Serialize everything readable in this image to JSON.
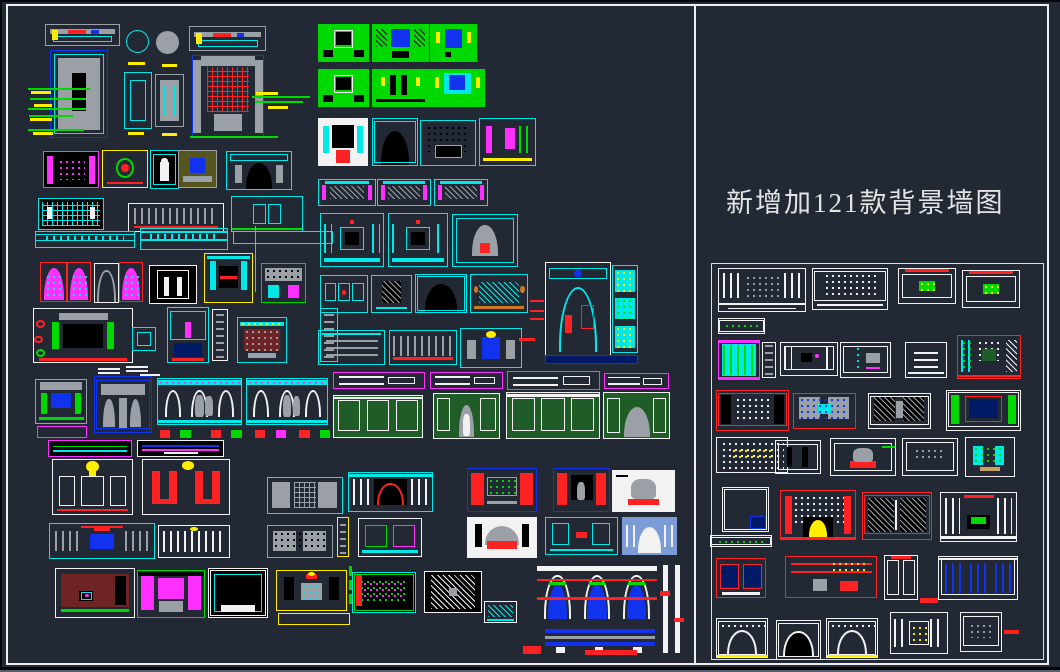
{
  "app": {
    "background_color": "#222935",
    "frame_color": "#eeeeee",
    "description": "CAD drawing sheet of background wall design elevations"
  },
  "title": {
    "text": "新增加121款背景墙图",
    "color": "#e3e3e3"
  },
  "palette": {
    "cy": "#00e8e8",
    "gr": "#00d900",
    "rd": "#ff2222",
    "mg": "#ff30ff",
    "yl": "#ffee00",
    "wh": "#f2f2f2",
    "gy": "#9aa0a6",
    "bl": "#1133ee",
    "nv": "#001a66",
    "dg": "#1f5c28",
    "mr": "#6e2424",
    "pw": "#7b9cd6",
    "bk": "#000000",
    "or": "#cc7a22",
    "tn": "#c8a165",
    "ol": "#55551e"
  },
  "drawings": {
    "blocks": [
      [
        45,
        24,
        75,
        22,
        "gy",
        "",
        "plan"
      ],
      [
        50,
        50,
        58,
        88,
        "bl",
        "",
        "tvblue"
      ],
      [
        126,
        30,
        23,
        23,
        "cy",
        "",
        "circle"
      ],
      [
        156,
        31,
        23,
        23,
        "gy",
        "gy",
        "circle"
      ],
      [
        124,
        72,
        28,
        57,
        "cy",
        "",
        "frame"
      ],
      [
        155,
        74,
        29,
        53,
        "gy",
        "",
        "slab"
      ],
      [
        189,
        26,
        77,
        25,
        "gy",
        "",
        "plan"
      ],
      [
        192,
        55,
        72,
        83,
        "bl",
        "",
        "redgrid"
      ],
      [
        43,
        151,
        56,
        37,
        "mg",
        "bk",
        "cols"
      ],
      [
        102,
        150,
        46,
        38,
        "yl",
        "",
        "art"
      ],
      [
        150,
        150,
        29,
        39,
        "cy",
        "bk",
        "jar"
      ],
      [
        178,
        150,
        39,
        38,
        "gy",
        "ol",
        "olive"
      ],
      [
        226,
        151,
        66,
        39,
        "cy",
        "",
        "fireplace"
      ],
      [
        38,
        198,
        66,
        32,
        "cy",
        "bk",
        "lattice"
      ],
      [
        128,
        203,
        96,
        29,
        "wh",
        "",
        "colonnade"
      ],
      [
        231,
        196,
        72,
        36,
        "cy",
        "",
        "window"
      ],
      [
        318,
        24,
        51,
        38,
        "gr",
        "gr",
        "greenwall"
      ],
      [
        372,
        24,
        57,
        38,
        "gr",
        "gr",
        "greenwall2"
      ],
      [
        430,
        24,
        47,
        38,
        "gr",
        "gr",
        "greenwall3"
      ],
      [
        318,
        69,
        51,
        38,
        "gr",
        "gr",
        "greenwall"
      ],
      [
        372,
        69,
        57,
        38,
        "gr",
        "gr",
        "greenwall4"
      ],
      [
        429,
        69,
        56,
        38,
        "gr",
        "gr",
        "greenwall5"
      ],
      [
        318,
        118,
        50,
        48,
        "wh",
        "wh",
        "whiteart"
      ],
      [
        372,
        118,
        46,
        48,
        "cy",
        "",
        "arch"
      ],
      [
        420,
        120,
        56,
        46,
        "cy",
        "",
        "dots"
      ],
      [
        479,
        118,
        57,
        48,
        "cy",
        "",
        "magdetail"
      ],
      [
        318,
        179,
        58,
        27,
        "cy",
        "",
        "sofa"
      ],
      [
        377,
        179,
        54,
        27,
        "cy",
        "",
        "sofa"
      ],
      [
        434,
        179,
        54,
        27,
        "cy",
        "",
        "sofa"
      ],
      [
        320,
        213,
        64,
        54,
        "cy",
        "",
        "ornate"
      ],
      [
        388,
        213,
        60,
        54,
        "cy",
        "",
        "ornate"
      ],
      [
        452,
        214,
        66,
        53,
        "cy",
        "",
        "archfire"
      ],
      [
        320,
        275,
        48,
        38,
        "cy",
        "",
        "panel3"
      ],
      [
        371,
        275,
        41,
        38,
        "cy",
        "",
        "mirror"
      ],
      [
        415,
        274,
        52,
        39,
        "cy",
        "",
        "arch"
      ],
      [
        470,
        274,
        58,
        39,
        "cy",
        "",
        "xlattice"
      ],
      [
        318,
        330,
        67,
        35,
        "cy",
        "",
        "bands"
      ],
      [
        389,
        330,
        68,
        35,
        "cy",
        "",
        "colonnade"
      ],
      [
        460,
        328,
        62,
        40,
        "cy",
        "",
        "throne"
      ],
      [
        545,
        262,
        66,
        96,
        "wh",
        "",
        "archbig"
      ],
      [
        612,
        265,
        26,
        88,
        "cy",
        "",
        "smallpanels"
      ],
      [
        545,
        355,
        93,
        9,
        "bl",
        "nv",
        "strip"
      ],
      [
        35,
        231,
        100,
        17,
        "cy",
        "",
        "beam"
      ],
      [
        140,
        228,
        88,
        22,
        "cy",
        "",
        "beam"
      ],
      [
        233,
        231,
        100,
        13,
        "cy",
        "",
        "strip"
      ],
      [
        40,
        262,
        27,
        40,
        "rd",
        "",
        "archstain"
      ],
      [
        67,
        262,
        24,
        40,
        "rd",
        "",
        "archstain"
      ],
      [
        94,
        263,
        25,
        40,
        "wh",
        "",
        "archgray"
      ],
      [
        119,
        262,
        24,
        40,
        "rd",
        "",
        "archstain"
      ],
      [
        149,
        265,
        48,
        39,
        "wh",
        "bk",
        "doorframe"
      ],
      [
        204,
        253,
        49,
        50,
        "yl",
        "",
        "yellowbox"
      ],
      [
        261,
        263,
        45,
        40,
        "gr",
        "",
        "hutch"
      ],
      [
        33,
        308,
        100,
        55,
        "wh",
        "",
        "leaderhouse"
      ],
      [
        132,
        327,
        24,
        24,
        "cy",
        "",
        "smallbox"
      ],
      [
        167,
        307,
        42,
        56,
        "cy",
        "",
        "tvnavy"
      ],
      [
        212,
        309,
        16,
        52,
        "wh",
        "",
        "column"
      ],
      [
        237,
        317,
        50,
        46,
        "cy",
        "",
        "maroonsofa"
      ],
      [
        320,
        308,
        18,
        54,
        "cy",
        "",
        "column"
      ],
      [
        35,
        379,
        52,
        45,
        "gy",
        "",
        "graygreen"
      ],
      [
        37,
        426,
        50,
        12,
        "mg",
        "",
        "strip"
      ],
      [
        94,
        376,
        58,
        57,
        "bl",
        "",
        "pavilion"
      ],
      [
        157,
        378,
        85,
        47,
        "cy",
        "",
        "peoplecol"
      ],
      [
        246,
        378,
        82,
        47,
        "cy",
        "",
        "peoplecol"
      ],
      [
        160,
        428,
        170,
        12,
        "",
        "",
        "pedestals"
      ],
      [
        48,
        440,
        84,
        17,
        "mg",
        "bk",
        "sectionstrip"
      ],
      [
        137,
        440,
        87,
        17,
        "wh",
        "bk",
        "sectionstrip2"
      ],
      [
        52,
        459,
        81,
        56,
        "wh",
        "",
        "chandelier"
      ],
      [
        142,
        459,
        88,
        56,
        "wh",
        "",
        "redU"
      ],
      [
        267,
        477,
        76,
        37,
        "cy",
        "",
        "grayhatch"
      ],
      [
        49,
        523,
        106,
        36,
        "cy",
        "",
        "crownwall"
      ],
      [
        158,
        525,
        72,
        33,
        "wh",
        "",
        "whitecols"
      ],
      [
        267,
        525,
        66,
        33,
        "gy",
        "",
        "graypanels"
      ],
      [
        55,
        568,
        80,
        50,
        "wh",
        "",
        "maroontv"
      ],
      [
        137,
        570,
        68,
        48,
        "gr",
        "",
        "magentawall"
      ],
      [
        208,
        568,
        60,
        50,
        "wh",
        "bk",
        "blackfire"
      ],
      [
        276,
        570,
        71,
        41,
        "yl",
        "",
        "yellowwall"
      ],
      [
        278,
        613,
        72,
        12,
        "yl",
        "",
        "strip"
      ],
      [
        352,
        572,
        64,
        41,
        "cy",
        "bk",
        "speckle"
      ],
      [
        424,
        571,
        58,
        42,
        "wh",
        "bk",
        "diaghatch"
      ],
      [
        484,
        601,
        33,
        22,
        "wh",
        "",
        "hatchdetail"
      ],
      [
        537,
        563,
        120,
        62,
        "",
        "",
        "archtrio"
      ],
      [
        545,
        628,
        110,
        25,
        "",
        "",
        "barstack"
      ],
      [
        660,
        565,
        25,
        88,
        "",
        "",
        "vbars"
      ],
      [
        333,
        372,
        92,
        17,
        "mg",
        "",
        "cornice"
      ],
      [
        430,
        372,
        73,
        17,
        "mg",
        "",
        "cornice"
      ],
      [
        507,
        371,
        93,
        19,
        "mg",
        "",
        "cornice"
      ],
      [
        604,
        373,
        65,
        16,
        "mg",
        "",
        "cornice"
      ],
      [
        333,
        395,
        90,
        43,
        "wh",
        "dg",
        "greenpanel"
      ],
      [
        433,
        393,
        67,
        46,
        "wh",
        "dg",
        "greenpanelperson"
      ],
      [
        506,
        392,
        94,
        47,
        "wh",
        "dg",
        "greenpanel"
      ],
      [
        603,
        392,
        67,
        47,
        "wh",
        "dg",
        "greenpanelarch"
      ],
      [
        348,
        472,
        85,
        40,
        "cy",
        "",
        "redarchwall"
      ],
      [
        467,
        468,
        70,
        44,
        "bl",
        "",
        "reddoors"
      ],
      [
        553,
        468,
        57,
        44,
        "bl",
        "",
        "reddoors2"
      ],
      [
        612,
        470,
        63,
        42,
        "wh",
        "wh",
        "treewall"
      ],
      [
        467,
        517,
        70,
        41,
        "wh",
        "wh",
        "firesofa"
      ],
      [
        545,
        517,
        73,
        38,
        "cy",
        "",
        "cyanwall"
      ],
      [
        622,
        517,
        55,
        38,
        "pw",
        "pw",
        "bluearch"
      ],
      [
        337,
        517,
        12,
        40,
        "yl",
        "",
        "column"
      ],
      [
        358,
        518,
        64,
        39,
        "wh",
        "",
        "mixed"
      ],
      [
        718,
        268,
        88,
        44,
        "wh",
        "",
        "wlattice"
      ],
      [
        812,
        268,
        76,
        42,
        "wh",
        "",
        "wdots"
      ],
      [
        898,
        268,
        58,
        36,
        "wh",
        "",
        "wgreens"
      ],
      [
        962,
        270,
        58,
        38,
        "wh",
        "",
        "wgreens"
      ],
      [
        718,
        318,
        47,
        16,
        "wh",
        "",
        "wstrip2"
      ],
      [
        718,
        340,
        42,
        40,
        "mg",
        "",
        "wcabinet"
      ],
      [
        762,
        342,
        14,
        36,
        "wh",
        "",
        "column"
      ],
      [
        780,
        342,
        58,
        34,
        "wh",
        "",
        "wblacksq"
      ],
      [
        840,
        342,
        51,
        36,
        "wh",
        "",
        "wteal"
      ],
      [
        905,
        342,
        42,
        36,
        "wh",
        "",
        "wdash"
      ],
      [
        957,
        335,
        64,
        44,
        "rd",
        "",
        "wredtv"
      ],
      [
        716,
        390,
        73,
        41,
        "rd",
        "",
        "wxdots"
      ],
      [
        793,
        393,
        63,
        36,
        "rd",
        "",
        "wgray"
      ],
      [
        868,
        393,
        63,
        36,
        "wh",
        "",
        "wdiag"
      ],
      [
        946,
        390,
        75,
        41,
        "wh",
        "",
        "wblackframe"
      ],
      [
        716,
        437,
        72,
        36,
        "wh",
        "",
        "wdotgrid"
      ],
      [
        775,
        440,
        46,
        34,
        "wh",
        "",
        "wpillars"
      ],
      [
        830,
        438,
        66,
        38,
        "wh",
        "",
        "wgreenbits"
      ],
      [
        902,
        438,
        56,
        38,
        "wh",
        "",
        "wsq"
      ],
      [
        965,
        437,
        50,
        40,
        "wh",
        "",
        "wtoilets"
      ],
      [
        722,
        487,
        47,
        45,
        "wh",
        "",
        "wsquare"
      ],
      [
        710,
        535,
        62,
        12,
        "wh",
        "",
        "wstrip2"
      ],
      [
        780,
        490,
        76,
        50,
        "rd",
        "",
        "wreddots"
      ],
      [
        862,
        492,
        70,
        48,
        "rd",
        "",
        "wblackhatch"
      ],
      [
        940,
        492,
        77,
        50,
        "wh",
        "",
        "wwhitered"
      ],
      [
        716,
        558,
        50,
        40,
        "rd",
        "",
        "wbluepair"
      ],
      [
        785,
        556,
        92,
        42,
        "rd",
        "",
        "wredlines"
      ],
      [
        884,
        555,
        34,
        45,
        "wh",
        "",
        "wpair"
      ],
      [
        938,
        556,
        80,
        44,
        "wh",
        "",
        "wbluestripes"
      ],
      [
        716,
        618,
        52,
        40,
        "wh",
        "",
        "warchgate"
      ],
      [
        776,
        620,
        45,
        40,
        "wh",
        "",
        "wdome"
      ],
      [
        826,
        618,
        52,
        40,
        "wh",
        "",
        "warchgate"
      ],
      [
        890,
        612,
        58,
        42,
        "wh",
        "",
        "wcolcab"
      ],
      [
        960,
        612,
        42,
        40,
        "wh",
        "",
        "wsq"
      ]
    ],
    "lines": [
      [
        28,
        88,
        62,
        2,
        "gr"
      ],
      [
        30,
        98,
        56,
        2,
        "gr"
      ],
      [
        28,
        108,
        58,
        2,
        "gr"
      ],
      [
        29,
        115,
        44,
        2,
        "gr"
      ],
      [
        28,
        129,
        56,
        2,
        "gr"
      ],
      [
        31,
        91,
        20,
        3,
        "yl"
      ],
      [
        34,
        104,
        18,
        3,
        "yl"
      ],
      [
        30,
        118,
        22,
        3,
        "yl"
      ],
      [
        33,
        132,
        20,
        3,
        "yl"
      ],
      [
        128,
        62,
        17,
        3,
        "yl"
      ],
      [
        162,
        64,
        15,
        3,
        "yl"
      ],
      [
        128,
        132,
        16,
        3,
        "yl"
      ],
      [
        162,
        133,
        15,
        3,
        "yl"
      ],
      [
        252,
        96,
        58,
        2,
        "gr"
      ],
      [
        255,
        101,
        48,
        2,
        "gr"
      ],
      [
        256,
        92,
        22,
        3,
        "yl"
      ],
      [
        268,
        106,
        20,
        3,
        "yl"
      ],
      [
        190,
        136,
        88,
        2,
        "gr"
      ],
      [
        255,
        226,
        1,
        66,
        "gy"
      ],
      [
        98,
        368,
        22,
        2,
        "wh"
      ],
      [
        98,
        372,
        22,
        2,
        "wh"
      ],
      [
        126,
        366,
        22,
        2,
        "wh"
      ],
      [
        126,
        370,
        22,
        2,
        "wh"
      ],
      [
        140,
        374,
        20,
        2,
        "wh"
      ],
      [
        530,
        300,
        14,
        2,
        "rd"
      ],
      [
        530,
        310,
        14,
        2,
        "rd"
      ],
      [
        530,
        318,
        14,
        2,
        "rd"
      ],
      [
        519,
        338,
        16,
        3,
        "rd"
      ],
      [
        523,
        646,
        18,
        8,
        "rd"
      ],
      [
        585,
        650,
        52,
        5,
        "rd"
      ],
      [
        920,
        598,
        18,
        5,
        "rd"
      ],
      [
        1004,
        630,
        15,
        4,
        "rd"
      ],
      [
        349,
        566,
        3,
        10,
        "gr"
      ],
      [
        349,
        580,
        3,
        10,
        "gr"
      ],
      [
        349,
        594,
        3,
        10,
        "gr"
      ]
    ]
  }
}
